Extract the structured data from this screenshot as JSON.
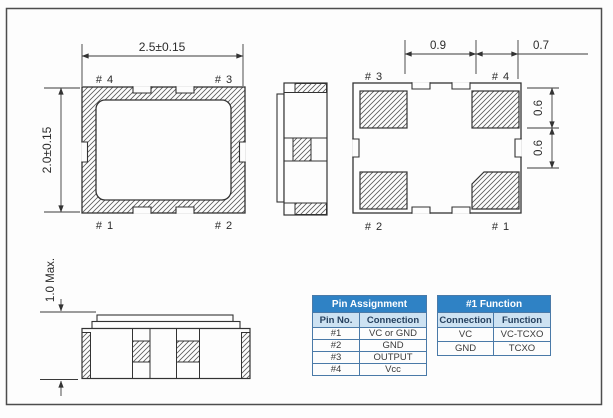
{
  "drawing": {
    "top_view": {
      "width_dim": "2.5±0.15",
      "height_dim": "2.0±0.15",
      "pin_top_left": "# 4",
      "pin_top_right": "# 3",
      "pin_bottom_left": "# 1",
      "pin_bottom_right": "# 2"
    },
    "bottom_view": {
      "pitch_dim": "0.9",
      "pad_width_dim": "0.7",
      "pad_height_dim": "0.6",
      "pad_gap_dim": "0.6",
      "pin_top_left": "# 3",
      "pin_top_right": "# 4",
      "pin_bottom_left": "# 2",
      "pin_bottom_right": "# 1"
    },
    "side_view": {
      "height_dim": "1.0 Max."
    }
  },
  "tables": {
    "pin_assignment": {
      "title": "Pin Assignment",
      "headers": [
        "Pin No.",
        "Connection"
      ],
      "rows": [
        [
          "#1",
          "VC or GND"
        ],
        [
          "#2",
          "GND"
        ],
        [
          "#3",
          "OUTPUT"
        ],
        [
          "#4",
          "Vcc"
        ]
      ]
    },
    "pin1_function": {
      "title": "#1 Function",
      "headers": [
        "Connection",
        "Function"
      ],
      "rows": [
        [
          "VC",
          "VC-TCXO"
        ],
        [
          "GND",
          "TCXO"
        ]
      ]
    }
  },
  "colors": {
    "line": "#333333",
    "hatch": "#5a5a5a",
    "table_header_bg": "#2f82c5",
    "table_header_text": "#ffffff",
    "table_subheader_bg": "#cde2f2",
    "table_border": "#4a7aa8"
  }
}
